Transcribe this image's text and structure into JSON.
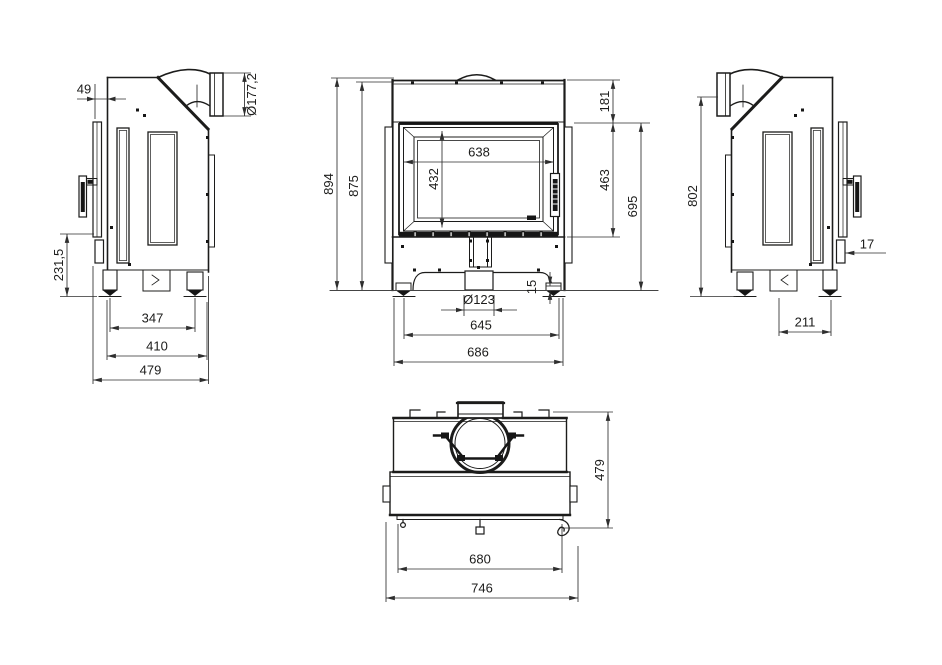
{
  "colors": {
    "background": "#ffffff",
    "line": "#1c1c1b",
    "dimension": "#2e2e2e"
  },
  "views": {
    "left_side": {
      "dims": {
        "front_offset": "49",
        "flue_outlet_diameter": "Ø177,2",
        "lower_section_height": "231,5",
        "feet_spacing": "347",
        "base_depth": "410",
        "overall_depth": "479"
      }
    },
    "front": {
      "dims": {
        "overall_height": "894",
        "body_height": "875",
        "glass_width": "638",
        "glass_height": "432",
        "hood_height": "181",
        "door_height": "463",
        "door_bottom_to_floor": "695",
        "foot_height": "15",
        "air_inlet_diameter": "Ø123",
        "feet_spacing": "645",
        "overall_width": "686"
      }
    },
    "right_side": {
      "dims": {
        "rear_height": "802",
        "frame_flange_depth": "17",
        "foot_offset": "211"
      }
    },
    "top": {
      "dims": {
        "overall_depth": "479",
        "body_width": "680",
        "overall_width": "746"
      }
    }
  }
}
